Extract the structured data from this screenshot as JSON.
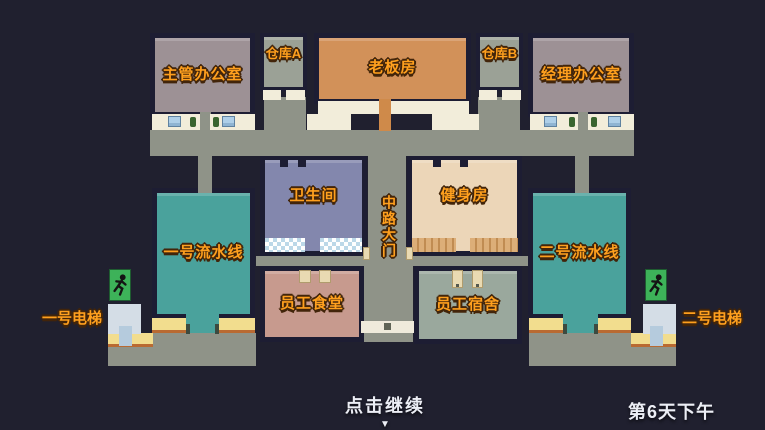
{
  "rooms": {
    "supervisor_office": {
      "label": "主管办公室"
    },
    "warehouse_a": {
      "label": "仓库A"
    },
    "boss_room": {
      "label": "老板房"
    },
    "warehouse_b": {
      "label": "仓库B"
    },
    "manager_office": {
      "label": "经理办公室"
    },
    "bathroom": {
      "label": "卫生间"
    },
    "gym": {
      "label": "健身房"
    },
    "assembly_line_1": {
      "label": "一号流水线"
    },
    "assembly_line_2": {
      "label": "二号流水线"
    },
    "staff_canteen": {
      "label": "员工食堂"
    },
    "staff_dorm": {
      "label": "员工宿舍"
    }
  },
  "corridor": {
    "center_gate_label": "中路大门"
  },
  "elevators": {
    "elevator_1": {
      "label": "一号电梯"
    },
    "elevator_2": {
      "label": "二号电梯"
    }
  },
  "footer": {
    "continue_label": "点击继续",
    "continue_arrow": "▼",
    "day_label": "第6天下午"
  },
  "icons": {
    "exit_sign": "running-man-exit"
  },
  "colors": {
    "background": "#20202f",
    "wall": "#1d1d33",
    "corridor": "#8f9388",
    "counter_white": "#f2edda",
    "office": "#9d9195",
    "warehouse": "#9ba196",
    "boss_room": "#d29159",
    "bathroom": "#8387ad",
    "gym": "#ecd6b8",
    "assembly_line": "#4aa29c",
    "canteen": "#c79a8e",
    "dorm": "#9aa89d",
    "floor_yellow": "#f2dd8e",
    "exit_green": "#3db259",
    "elevator": "#d4dde6",
    "label_orange": "#ffa01e",
    "footer_text": "#eceef5"
  }
}
